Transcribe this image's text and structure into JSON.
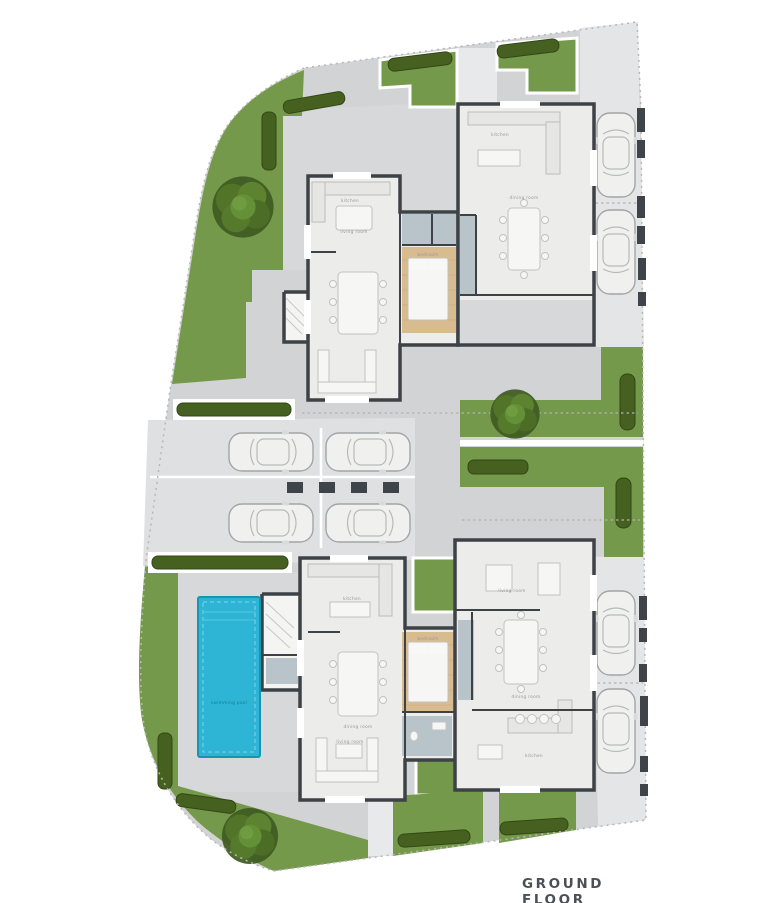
{
  "title": "GROUND FLOOR",
  "colors": {
    "grass": "#75994a",
    "hedge": "#46611f",
    "pool": "#2eb5d6",
    "pool_edge": "#1694b2",
    "wall": "#3d4247",
    "floor": "#ecedeb",
    "pavement": "#d2d3d5",
    "driveway": "#e4e5e7",
    "parking": "#dfe0e2",
    "wood": "#d9bb90",
    "tile": "#b9c4ca",
    "title_color": "#4b5057"
  },
  "labels": {
    "living_room": "living room",
    "dining_room": "dining room",
    "kitchen": "kitchen",
    "bedroom": "bedroom",
    "swimming_pool": "swimming pool"
  }
}
